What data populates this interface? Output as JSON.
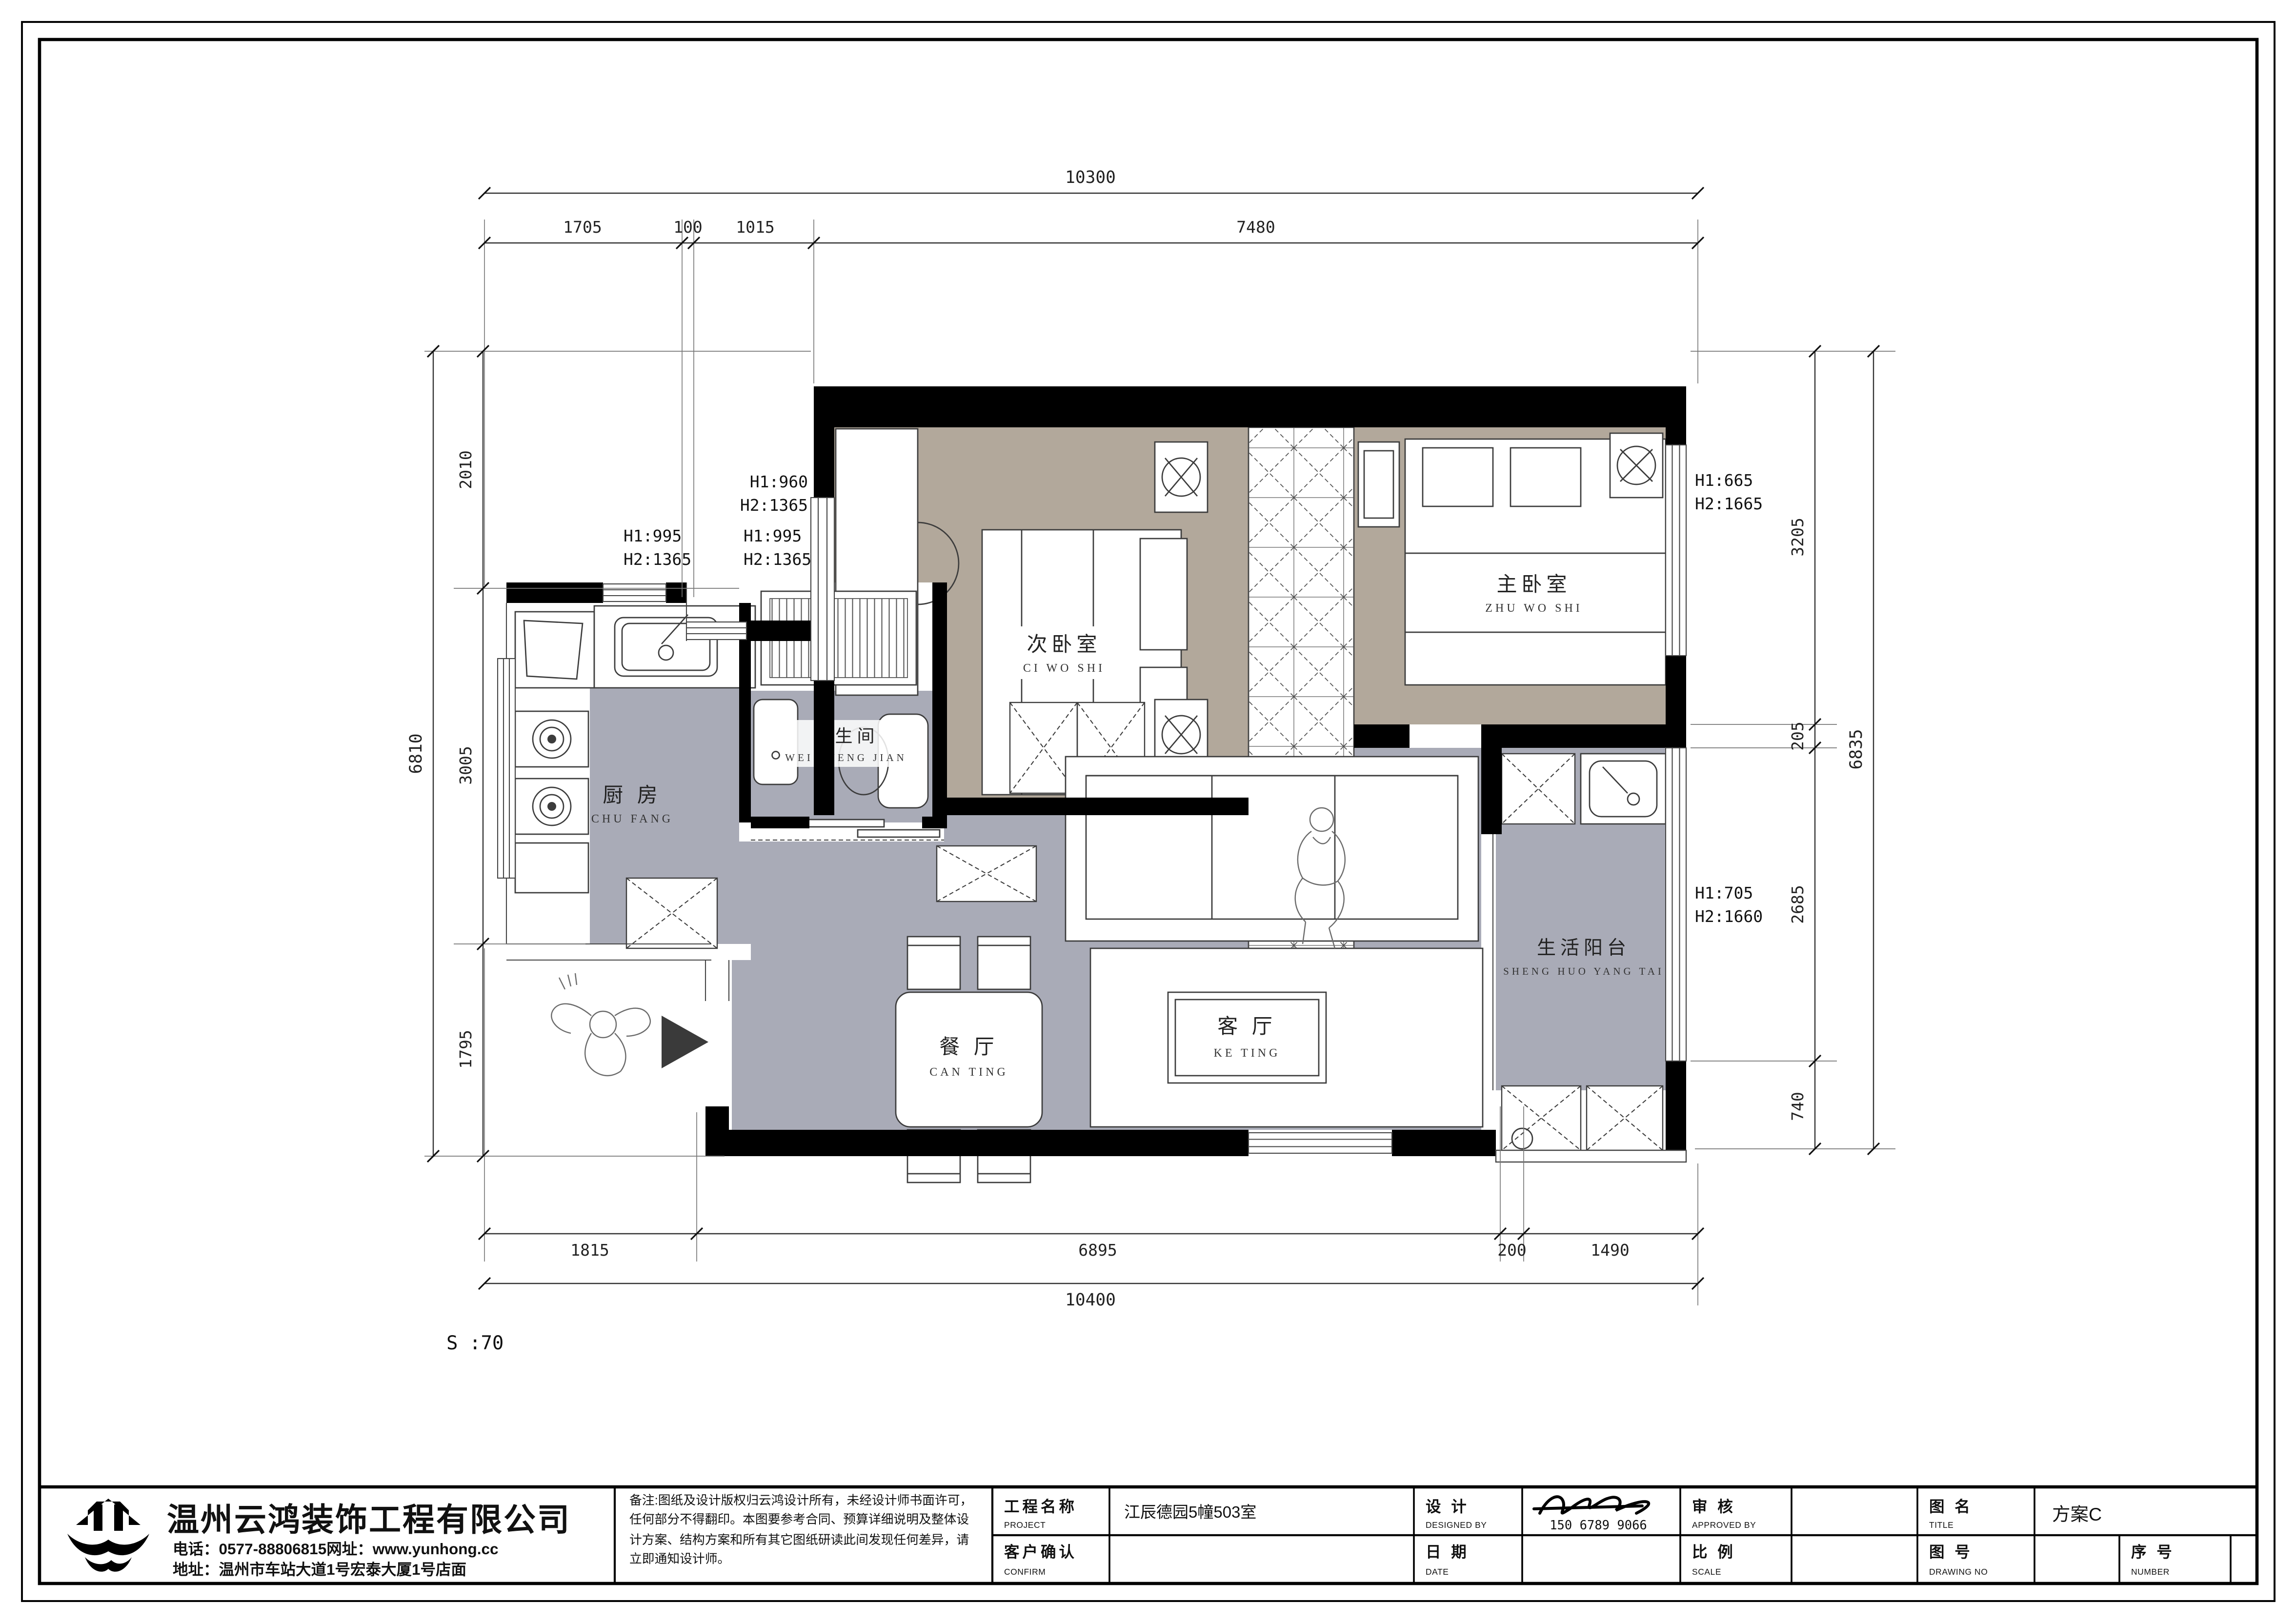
{
  "colors": {
    "bedroom_floor": "#b2a89b",
    "hall_floor": "#a9abb7",
    "wall": "#000000",
    "paper": "#ffffff"
  },
  "dims": {
    "top": {
      "overall": "10300",
      "segments": [
        "1705",
        "100",
        "1015",
        "7480"
      ]
    },
    "bottom": {
      "overall": "10400",
      "segments": [
        "1815",
        "6895",
        "200",
        "1490"
      ]
    },
    "left": {
      "overall": "6810",
      "segments": [
        "2010",
        "3005",
        "1795"
      ]
    },
    "right": {
      "overall": "6835",
      "segments": [
        "3205",
        "205",
        "2685",
        "740"
      ]
    }
  },
  "annotations": {
    "win_a": {
      "h1": "H1:960",
      "h2": "H2:1365"
    },
    "win_b": {
      "h1": "H1:995",
      "h2": "H2:1365"
    },
    "win_c": {
      "h1": "H1:995",
      "h2": "H2:1365"
    },
    "win_d": {
      "h1": "H1:665",
      "h2": "H2:1665"
    },
    "win_e": {
      "h1": "H1:705",
      "h2": "H2:1660"
    },
    "scale_note": "S :70"
  },
  "rooms": {
    "ci_wo_shi": {
      "cn": "次卧室",
      "en": "CI WO SHI"
    },
    "zhu_wo_shi": {
      "cn": "主卧室",
      "en": "ZHU WO SHI"
    },
    "wei_sheng_jian": {
      "cn": "卫生间",
      "en": "WEI SHENG JIAN"
    },
    "chu_fang": {
      "cn": "厨 房",
      "en": "CHU FANG"
    },
    "can_ting": {
      "cn": "餐 厅",
      "en": "CAN TING"
    },
    "ke_ting": {
      "cn": "客 厅",
      "en": "KE TING"
    },
    "sheng_huo_yang_tai": {
      "cn": "生活阳台",
      "en": "SHENG HUO YANG TAI"
    }
  },
  "title_block": {
    "company": {
      "name": "温州云鸿装饰工程有限公司",
      "phone_line": "电话：0577-88806815网址：www.yunhong.cc",
      "address_line": "地址：温州市车站大道1号宏泰大厦1号店面"
    },
    "notes": "备注:图纸及设计版权归云鸿设计所有，未经设计师书面许可，任何部分不得翻印。本图要参考合同、预算详细说明及整体设计方案、结构方案和所有其它图纸研读此间发现任何差异，请立即通知设计师。",
    "fields": {
      "project": {
        "cn": "工程名称",
        "en": "PROJECT",
        "value": "江辰德园5幢503室"
      },
      "designed": {
        "cn": "设 计",
        "en": "DESIGNED BY",
        "value": "150 6789 9066"
      },
      "approved": {
        "cn": "审 核",
        "en": "APPROVED BY",
        "value": ""
      },
      "confirm": {
        "cn": "客户确认",
        "en": "CONFIRM",
        "value": ""
      },
      "date": {
        "cn": "日 期",
        "en": "DATE",
        "value": ""
      },
      "scale": {
        "cn": "比 例",
        "en": "SCALE",
        "value": ""
      },
      "title": {
        "cn": "图 名",
        "en": "TITLE",
        "value": "方案C"
      },
      "drawing_no": {
        "cn": "图 号",
        "en": "DRAWING NO",
        "value": ""
      },
      "number": {
        "cn": "序 号",
        "en": "NUMBER",
        "value": ""
      }
    }
  }
}
